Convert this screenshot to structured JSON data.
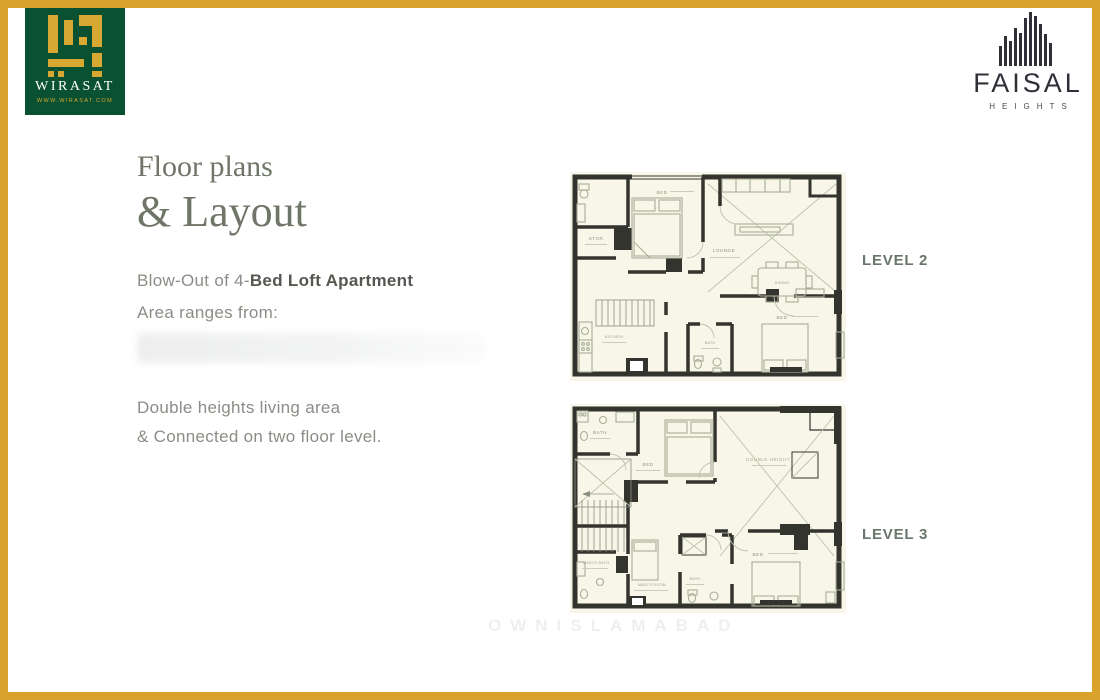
{
  "branding": {
    "wirasat": {
      "name": "WIRASAT",
      "website": "WWW.WIRASAT.COM"
    },
    "faisal": {
      "name": "FAISAL",
      "tagline": "HEIGHTS"
    }
  },
  "content": {
    "title_line1": "Floor plans",
    "title_line2": "& Layout",
    "subtitle_prefix": "Blow-Out of 4-",
    "subtitle_bold": "Bed Loft Apartment",
    "area_label": "Area ranges from:",
    "feature_line1": "Double heights living area",
    "feature_line2": "& Connected on two floor level."
  },
  "plans": {
    "level2": {
      "label": "LEVEL 2",
      "rooms": {
        "stor": "STOR",
        "bed_top": "BED",
        "lounge": "LOUNGE",
        "dining": "DINING",
        "kitchen": "KITCHEN",
        "bath": "BATH",
        "bed_bottom": "BED"
      }
    },
    "level3": {
      "label": "LEVEL 3",
      "rooms": {
        "bath_top": "BATH",
        "bed_top": "BED",
        "double_height": "DOUBLE HEIGHT",
        "maids_bath": "MAID'S BATH",
        "maids_room": "MAID'S ROOM",
        "bath_bottom": "BATH",
        "bed_bottom": "BED"
      }
    }
  },
  "watermark": "OWNISLAMABAD",
  "colors": {
    "border_gold": "#D9A32B",
    "wirasat_green": "#0A5132",
    "logo_gold": "#D7A832",
    "title_text": "#6F7668",
    "body_text": "#8A8E86",
    "level_label": "#68766C",
    "plan_background": "#F7F6E8",
    "plan_wall": "#34342E"
  }
}
